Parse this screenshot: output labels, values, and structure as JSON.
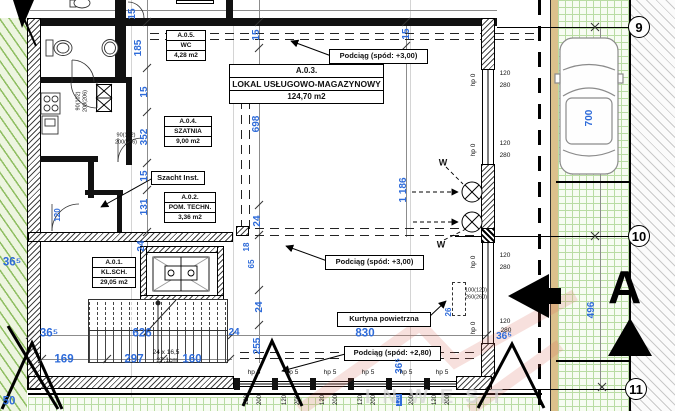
{
  "drawing": {
    "rooms": [
      {
        "id": "A.0.1.",
        "name": "KL.SCH.",
        "area": "29,05 m2"
      },
      {
        "id": "A.0.2.",
        "name": "POM. TECHN.",
        "area": "3,36 m2"
      },
      {
        "id": "A.0.3.",
        "name": "LOKAL USŁUGOWO-MAGAZYNOWY",
        "area": "124,70 m2"
      },
      {
        "id": "A.0.4.",
        "name": "SZATNIA",
        "area": "9,00 m2"
      },
      {
        "id": "A.0.5.",
        "name": "WC",
        "area": "4,28 m2"
      }
    ],
    "callouts": {
      "podciag_300a": "Podciąg (spód: +3,00)",
      "podciag_300b": "Podciąg (spód: +3,00)",
      "podciag_280": "Podciąg (spód: +2,80)",
      "kurtyna": "Kurtyna powietrzna",
      "szacht": "Szacht Inst."
    },
    "grid_bubbles": [
      {
        "label": "9"
      },
      {
        "label": "10"
      },
      {
        "label": "11"
      }
    ],
    "section_label": "A",
    "watermark": "INWEST",
    "colors": {
      "dim_blue": "#2e6bd9",
      "green_hatch": "#8fbe62",
      "grass_grid": "#b9dca3",
      "tan": "#dcc18c",
      "wall": "#111111",
      "watermark_red": "#e8a29a"
    },
    "annotations": [
      {
        "t": "15",
        "x": 133,
        "y": 14,
        "r": -90,
        "c": "d"
      },
      {
        "t": "185",
        "x": 139,
        "y": 48,
        "r": -90,
        "c": "d"
      },
      {
        "t": "15",
        "x": 145,
        "y": 92,
        "r": -90,
        "c": "d"
      },
      {
        "t": "352",
        "x": 145,
        "y": 137,
        "r": -90,
        "c": "d"
      },
      {
        "t": "15",
        "x": 145,
        "y": 176,
        "r": -90,
        "c": "d"
      },
      {
        "t": "131",
        "x": 145,
        "y": 207,
        "r": -90,
        "c": "d"
      },
      {
        "t": "24",
        "x": 142,
        "y": 246,
        "r": -90,
        "c": "d"
      },
      {
        "t": "120",
        "x": 58,
        "y": 215,
        "r": -90,
        "c": "ds"
      },
      {
        "t": "36⁵",
        "x": 12,
        "y": 263,
        "r": 0,
        "c": "D"
      },
      {
        "t": "15",
        "x": 257,
        "y": 35,
        "r": -90,
        "c": "d"
      },
      {
        "t": "698",
        "x": 257,
        "y": 124,
        "r": -90,
        "c": "d"
      },
      {
        "t": "24",
        "x": 258,
        "y": 221,
        "r": -90,
        "c": "d"
      },
      {
        "t": "18",
        "x": 247,
        "y": 247,
        "r": -90,
        "c": "ds"
      },
      {
        "t": "65",
        "x": 252,
        "y": 264,
        "r": -90,
        "c": "ds"
      },
      {
        "t": "24",
        "x": 260,
        "y": 307,
        "r": -90,
        "c": "d"
      },
      {
        "t": "255",
        "x": 258,
        "y": 346,
        "r": -90,
        "c": "d"
      },
      {
        "t": "24",
        "x": 234,
        "y": 333,
        "r": 0,
        "c": "d"
      },
      {
        "t": "15",
        "x": 407,
        "y": 34,
        "r": -90,
        "c": "d"
      },
      {
        "t": "1 186",
        "x": 404,
        "y": 190,
        "r": -90,
        "c": "d"
      },
      {
        "t": "36⁵",
        "x": 400,
        "y": 366,
        "r": -90,
        "c": "d"
      },
      {
        "t": "36⁵",
        "x": 49,
        "y": 334,
        "r": 0,
        "c": "D"
      },
      {
        "t": "626",
        "x": 142,
        "y": 334,
        "r": 0,
        "c": "D"
      },
      {
        "t": "169",
        "x": 64,
        "y": 360,
        "r": 0,
        "c": "D"
      },
      {
        "t": "297",
        "x": 134,
        "y": 360,
        "r": 0,
        "c": "D"
      },
      {
        "t": "160",
        "x": 192,
        "y": 360,
        "r": 0,
        "c": "D"
      },
      {
        "t": "830",
        "x": 365,
        "y": 334,
        "r": 0,
        "c": "D"
      },
      {
        "t": "50",
        "x": 9,
        "y": 402,
        "r": 0,
        "c": "D"
      },
      {
        "t": "700",
        "x": 590,
        "y": 118,
        "r": -90,
        "c": "d"
      },
      {
        "t": "496",
        "x": 592,
        "y": 310,
        "r": -90,
        "c": "d"
      },
      {
        "t": "36⁵",
        "x": 504,
        "y": 337,
        "r": 0,
        "c": "d"
      },
      {
        "t": "26",
        "x": 449,
        "y": 312,
        "r": -90,
        "c": "ds"
      },
      {
        "t": "90(102)",
        "x": 79,
        "y": 101,
        "r": -90,
        "c": "t"
      },
      {
        "t": "200(206)",
        "x": 86,
        "y": 101,
        "r": -90,
        "c": "t"
      },
      {
        "t": "90(102)",
        "x": 126,
        "y": 136,
        "r": 0,
        "c": "t"
      },
      {
        "t": "200(206)",
        "x": 126,
        "y": 143,
        "r": 0,
        "c": "t"
      },
      {
        "t": "100(120)",
        "x": 476,
        "y": 291,
        "r": 0,
        "c": "t"
      },
      {
        "t": "260(260)",
        "x": 476,
        "y": 298,
        "r": 0,
        "c": "t"
      },
      {
        "t": "24 x 16,5",
        "x": 166,
        "y": 353,
        "r": 0,
        "c": "t2"
      },
      {
        "t": "27,1cm",
        "x": 167,
        "y": 361,
        "r": 0,
        "c": "t2"
      },
      {
        "t": "W",
        "x": 443,
        "y": 163,
        "r": 0,
        "c": "tb"
      },
      {
        "t": "W",
        "x": 441,
        "y": 245,
        "r": 0,
        "c": "tb"
      },
      {
        "t": "hp 0",
        "x": 474,
        "y": 80,
        "r": -90,
        "c": "h"
      },
      {
        "t": "120",
        "x": 505,
        "y": 74,
        "r": 0,
        "c": "h"
      },
      {
        "t": "280",
        "x": 505,
        "y": 86,
        "r": 0,
        "c": "h"
      },
      {
        "t": "hp 0",
        "x": 474,
        "y": 150,
        "r": -90,
        "c": "h"
      },
      {
        "t": "120",
        "x": 505,
        "y": 144,
        "r": 0,
        "c": "h"
      },
      {
        "t": "280",
        "x": 505,
        "y": 156,
        "r": 0,
        "c": "h"
      },
      {
        "t": "hp 0",
        "x": 474,
        "y": 262,
        "r": -90,
        "c": "h"
      },
      {
        "t": "120",
        "x": 505,
        "y": 256,
        "r": 0,
        "c": "h"
      },
      {
        "t": "280",
        "x": 505,
        "y": 268,
        "r": 0,
        "c": "h"
      },
      {
        "t": "hp 0",
        "x": 474,
        "y": 328,
        "r": -90,
        "c": "h"
      },
      {
        "t": "120",
        "x": 505,
        "y": 322,
        "r": 0,
        "c": "h"
      },
      {
        "t": "280",
        "x": 506,
        "y": 331,
        "r": 0,
        "c": "h"
      },
      {
        "t": "hp 5",
        "x": 254,
        "y": 373,
        "r": 0,
        "c": "h"
      },
      {
        "t": "hp 5",
        "x": 292,
        "y": 373,
        "r": 0,
        "c": "h"
      },
      {
        "t": "hp 5",
        "x": 330,
        "y": 373,
        "r": 0,
        "c": "h"
      },
      {
        "t": "hp 5",
        "x": 368,
        "y": 373,
        "r": 0,
        "c": "h"
      },
      {
        "t": "hp 5",
        "x": 406,
        "y": 373,
        "r": 0,
        "c": "h"
      },
      {
        "t": "hp 5",
        "x": 442,
        "y": 373,
        "r": 0,
        "c": "h"
      },
      {
        "t": "120",
        "x": 247,
        "y": 400,
        "r": -90,
        "c": "w"
      },
      {
        "t": "200",
        "x": 260,
        "y": 400,
        "r": -90,
        "c": "w"
      },
      {
        "t": "120",
        "x": 285,
        "y": 400,
        "r": -90,
        "c": "w"
      },
      {
        "t": "200",
        "x": 298,
        "y": 400,
        "r": -90,
        "c": "w"
      },
      {
        "t": "120",
        "x": 323,
        "y": 400,
        "r": -90,
        "c": "w"
      },
      {
        "t": "200",
        "x": 336,
        "y": 400,
        "r": -90,
        "c": "w"
      },
      {
        "t": "120",
        "x": 361,
        "y": 400,
        "r": -90,
        "c": "w"
      },
      {
        "t": "200",
        "x": 374,
        "y": 400,
        "r": -90,
        "c": "w"
      },
      {
        "t": "120",
        "x": 399,
        "y": 400,
        "r": -90,
        "c": "w sel"
      },
      {
        "t": "200",
        "x": 412,
        "y": 400,
        "r": -90,
        "c": "w"
      },
      {
        "t": "120",
        "x": 435,
        "y": 400,
        "r": -90,
        "c": "w"
      },
      {
        "t": "200",
        "x": 448,
        "y": 400,
        "r": -90,
        "c": "w"
      }
    ]
  }
}
